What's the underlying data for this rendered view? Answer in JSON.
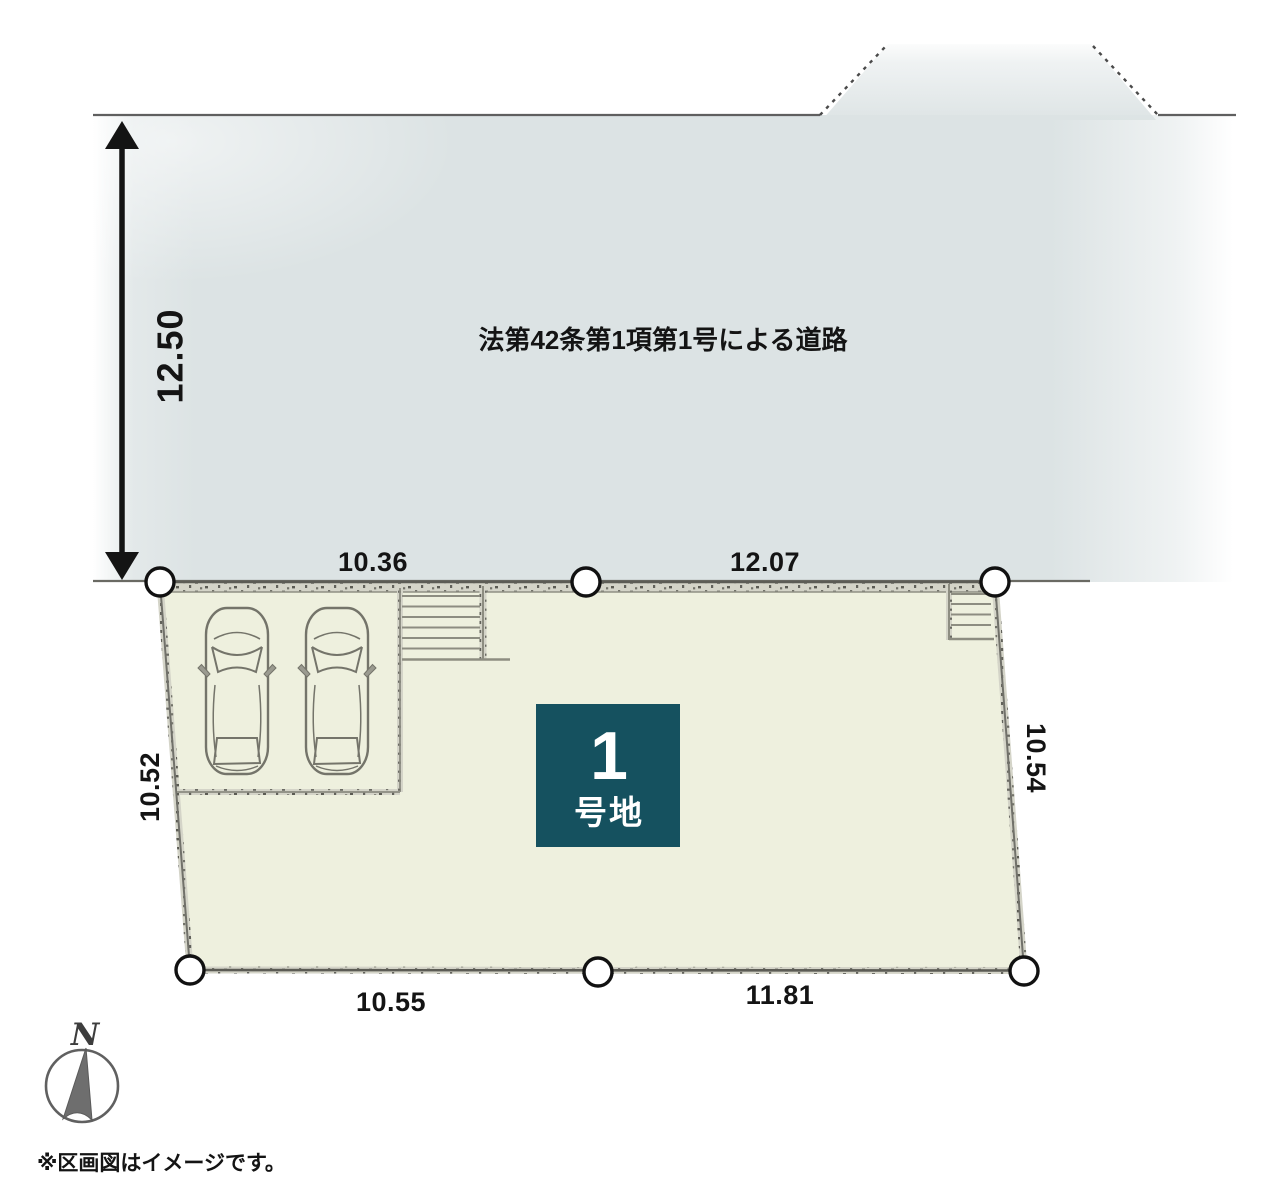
{
  "road": {
    "label": "法第42条第1項第1号による道路",
    "width_dimension": "12.50"
  },
  "lot": {
    "number": "1",
    "number_suffix": "号地",
    "dimensions": {
      "top_left": "10.36",
      "top_right": "12.07",
      "left": "10.52",
      "right": "10.54",
      "bottom_left": "10.55",
      "bottom_right": "11.81"
    }
  },
  "compass": {
    "north": "N"
  },
  "footnote": {
    "text": "※区画図はイメージです。"
  },
  "colors": {
    "road_fill": "#dce3e4",
    "lot_fill": "#eef0de",
    "badge_fill": "#15515f",
    "badge_text": "#ffffff",
    "boundary_band": "#d4d4c8",
    "boundary_core": "#71716a",
    "ink": "#141414"
  }
}
